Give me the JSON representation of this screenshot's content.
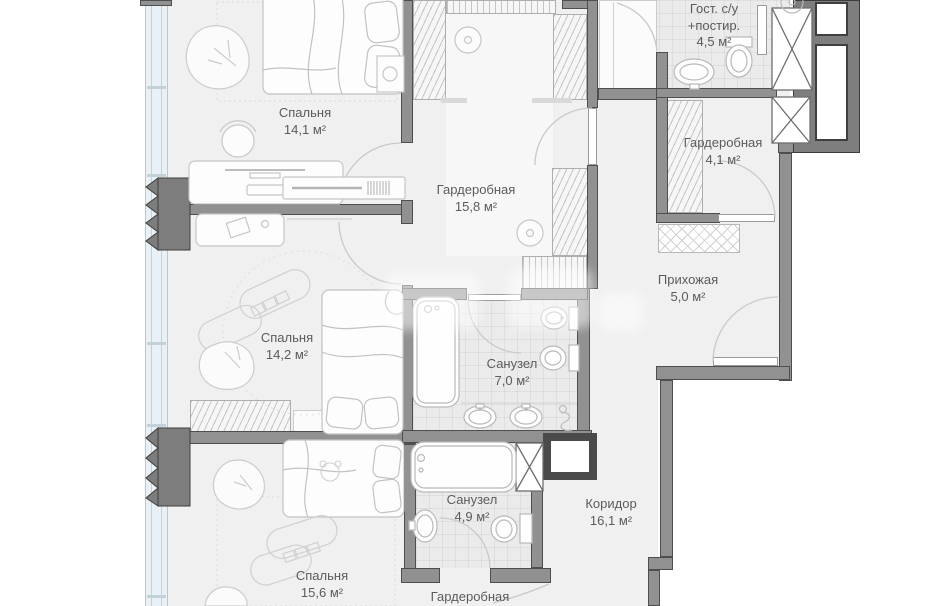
{
  "document": {
    "type": "apartment floor plan",
    "language": "ru"
  },
  "rooms": [
    {
      "id": "bedroom-1",
      "name": "Спальня",
      "area": "14,1 м²"
    },
    {
      "id": "wardrobe-main",
      "name": "Гардеробная",
      "area": "15,8 м²"
    },
    {
      "id": "guest-wc-laundry",
      "name": "Гост. с/у +постир.",
      "area": "4,5 м²"
    },
    {
      "id": "wardrobe-2",
      "name": "Гардеробная",
      "area": "4,1 м²"
    },
    {
      "id": "entry-hall",
      "name": "Прихожая",
      "area": "5,0 м²"
    },
    {
      "id": "bedroom-2",
      "name": "Спальня",
      "area": "14,2 м²"
    },
    {
      "id": "bathroom-1",
      "name": "Санузел",
      "area": "7,0 м²"
    },
    {
      "id": "bathroom-2",
      "name": "Санузел",
      "area": "4,9 м²"
    },
    {
      "id": "corridor",
      "name": "Коридор",
      "area": "16,1 м²"
    },
    {
      "id": "bedroom-3",
      "name": "Спальня",
      "area": "15,6 м²"
    },
    {
      "id": "wardrobe-3",
      "name": "Гардеробная",
      "area": ""
    }
  ],
  "colors": {
    "wall": "#919191",
    "wall_outline": "#4e4e4e",
    "floor": "#f0f0f0",
    "tile": "#ebebeb",
    "window_glass": "#e9f1f6",
    "label_text": "#5b5b5b",
    "outside": "#ffffff"
  }
}
